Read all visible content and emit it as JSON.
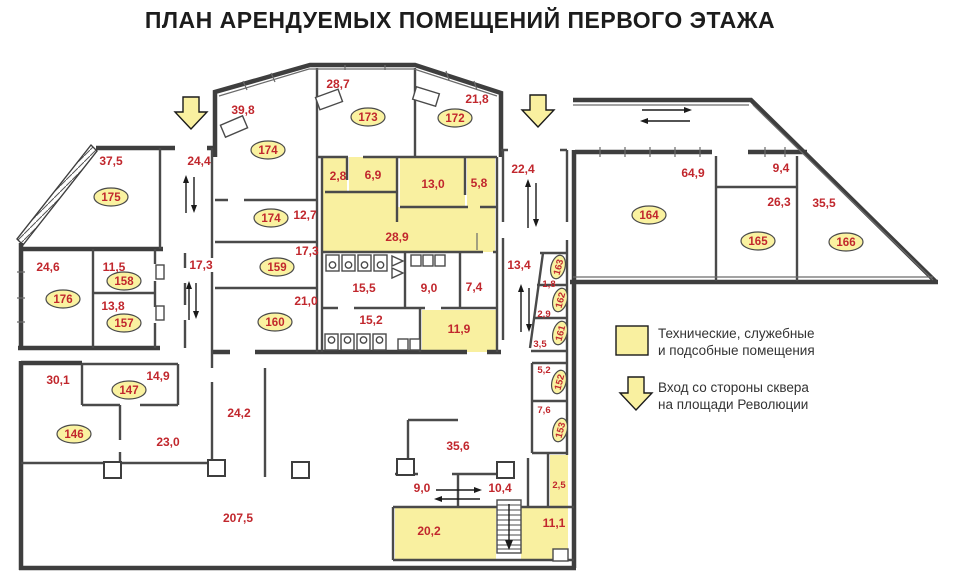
{
  "title": "ПЛАН АРЕНДУЕМЫХ ПОМЕЩЕНИЙ ПЕРВОГО ЭТАЖА",
  "colors": {
    "service_fill": "#F9F0A0",
    "badge_fill": "#FAF2A0",
    "label_red": "#C1272D",
    "wall_dark": "#3E3E3E"
  },
  "legend": {
    "service_line1": "Технические, служебные",
    "service_line2": "и подсобные помещения",
    "entrance_line1": "Вход со стороны сквера",
    "entrance_line2": "на площади Революции"
  },
  "area_labels": [
    {
      "v": "37,5",
      "x": 111,
      "y": 165
    },
    {
      "v": "24,4",
      "x": 199,
      "y": 165
    },
    {
      "v": "39,8",
      "x": 243,
      "y": 114
    },
    {
      "v": "28,7",
      "x": 338,
      "y": 88
    },
    {
      "v": "21,8",
      "x": 477,
      "y": 103
    },
    {
      "v": "22,4",
      "x": 523,
      "y": 173
    },
    {
      "v": "64,9",
      "x": 693,
      "y": 177
    },
    {
      "v": "9,4",
      "x": 781,
      "y": 172
    },
    {
      "v": "26,3",
      "x": 779,
      "y": 206
    },
    {
      "v": "35,5",
      "x": 824,
      "y": 207
    },
    {
      "v": "12,7",
      "x": 305,
      "y": 219
    },
    {
      "v": "2,8",
      "x": 338,
      "y": 180
    },
    {
      "v": "6,9",
      "x": 373,
      "y": 179
    },
    {
      "v": "13,0",
      "x": 433,
      "y": 188
    },
    {
      "v": "5,8",
      "x": 479,
      "y": 187
    },
    {
      "v": "28,9",
      "x": 397,
      "y": 241
    },
    {
      "v": "24,6",
      "x": 48,
      "y": 271
    },
    {
      "v": "11,5",
      "x": 114,
      "y": 271
    },
    {
      "v": "17,3",
      "x": 201,
      "y": 269
    },
    {
      "v": "17,3",
      "x": 307,
      "y": 255
    },
    {
      "v": "13,8",
      "x": 113,
      "y": 310
    },
    {
      "v": "21,0",
      "x": 306,
      "y": 305
    },
    {
      "v": "15,5",
      "x": 364,
      "y": 292
    },
    {
      "v": "9,0",
      "x": 429,
      "y": 292
    },
    {
      "v": "7,4",
      "x": 474,
      "y": 291
    },
    {
      "v": "15,2",
      "x": 371,
      "y": 324
    },
    {
      "v": "11,9",
      "x": 459,
      "y": 333
    },
    {
      "v": "13,4",
      "x": 519,
      "y": 269
    },
    {
      "v": "1,8",
      "x": 549,
      "y": 287,
      "small": true
    },
    {
      "v": "2,9",
      "x": 544,
      "y": 317,
      "small": true
    },
    {
      "v": "3,5",
      "x": 540,
      "y": 347,
      "small": true
    },
    {
      "v": "5,2",
      "x": 544,
      "y": 373,
      "small": true
    },
    {
      "v": "7,6",
      "x": 544,
      "y": 413,
      "small": true
    },
    {
      "v": "30,1",
      "x": 58,
      "y": 384
    },
    {
      "v": "14,9",
      "x": 158,
      "y": 380
    },
    {
      "v": "23,0",
      "x": 168,
      "y": 446
    },
    {
      "v": "24,2",
      "x": 239,
      "y": 417
    },
    {
      "v": "35,6",
      "x": 458,
      "y": 450
    },
    {
      "v": "9,0",
      "x": 422,
      "y": 492
    },
    {
      "v": "10,4",
      "x": 500,
      "y": 492
    },
    {
      "v": "2,5",
      "x": 559,
      "y": 488,
      "small": true
    },
    {
      "v": "207,5",
      "x": 238,
      "y": 522
    },
    {
      "v": "20,2",
      "x": 429,
      "y": 535
    },
    {
      "v": "11,1",
      "x": 554,
      "y": 527
    }
  ],
  "room_badges": [
    {
      "n": "175",
      "x": 111,
      "y": 197
    },
    {
      "n": "174",
      "x": 268,
      "y": 150
    },
    {
      "n": "173",
      "x": 368,
      "y": 117
    },
    {
      "n": "172",
      "x": 455,
      "y": 118
    },
    {
      "n": "174",
      "x": 271,
      "y": 218
    },
    {
      "n": "159",
      "x": 277,
      "y": 267
    },
    {
      "n": "160",
      "x": 275,
      "y": 322
    },
    {
      "n": "176",
      "x": 63,
      "y": 299
    },
    {
      "n": "158",
      "x": 124,
      "y": 281
    },
    {
      "n": "157",
      "x": 124,
      "y": 323
    },
    {
      "n": "164",
      "x": 649,
      "y": 215
    },
    {
      "n": "165",
      "x": 758,
      "y": 241
    },
    {
      "n": "166",
      "x": 846,
      "y": 242
    },
    {
      "n": "163",
      "x": 558,
      "y": 267,
      "rot": -75
    },
    {
      "n": "162",
      "x": 560,
      "y": 300,
      "rot": -75
    },
    {
      "n": "161",
      "x": 560,
      "y": 333,
      "rot": -75
    },
    {
      "n": "152",
      "x": 559,
      "y": 382,
      "rot": -75
    },
    {
      "n": "153",
      "x": 560,
      "y": 430,
      "rot": -75
    },
    {
      "n": "147",
      "x": 129,
      "y": 390
    },
    {
      "n": "146",
      "x": 74,
      "y": 434
    }
  ]
}
